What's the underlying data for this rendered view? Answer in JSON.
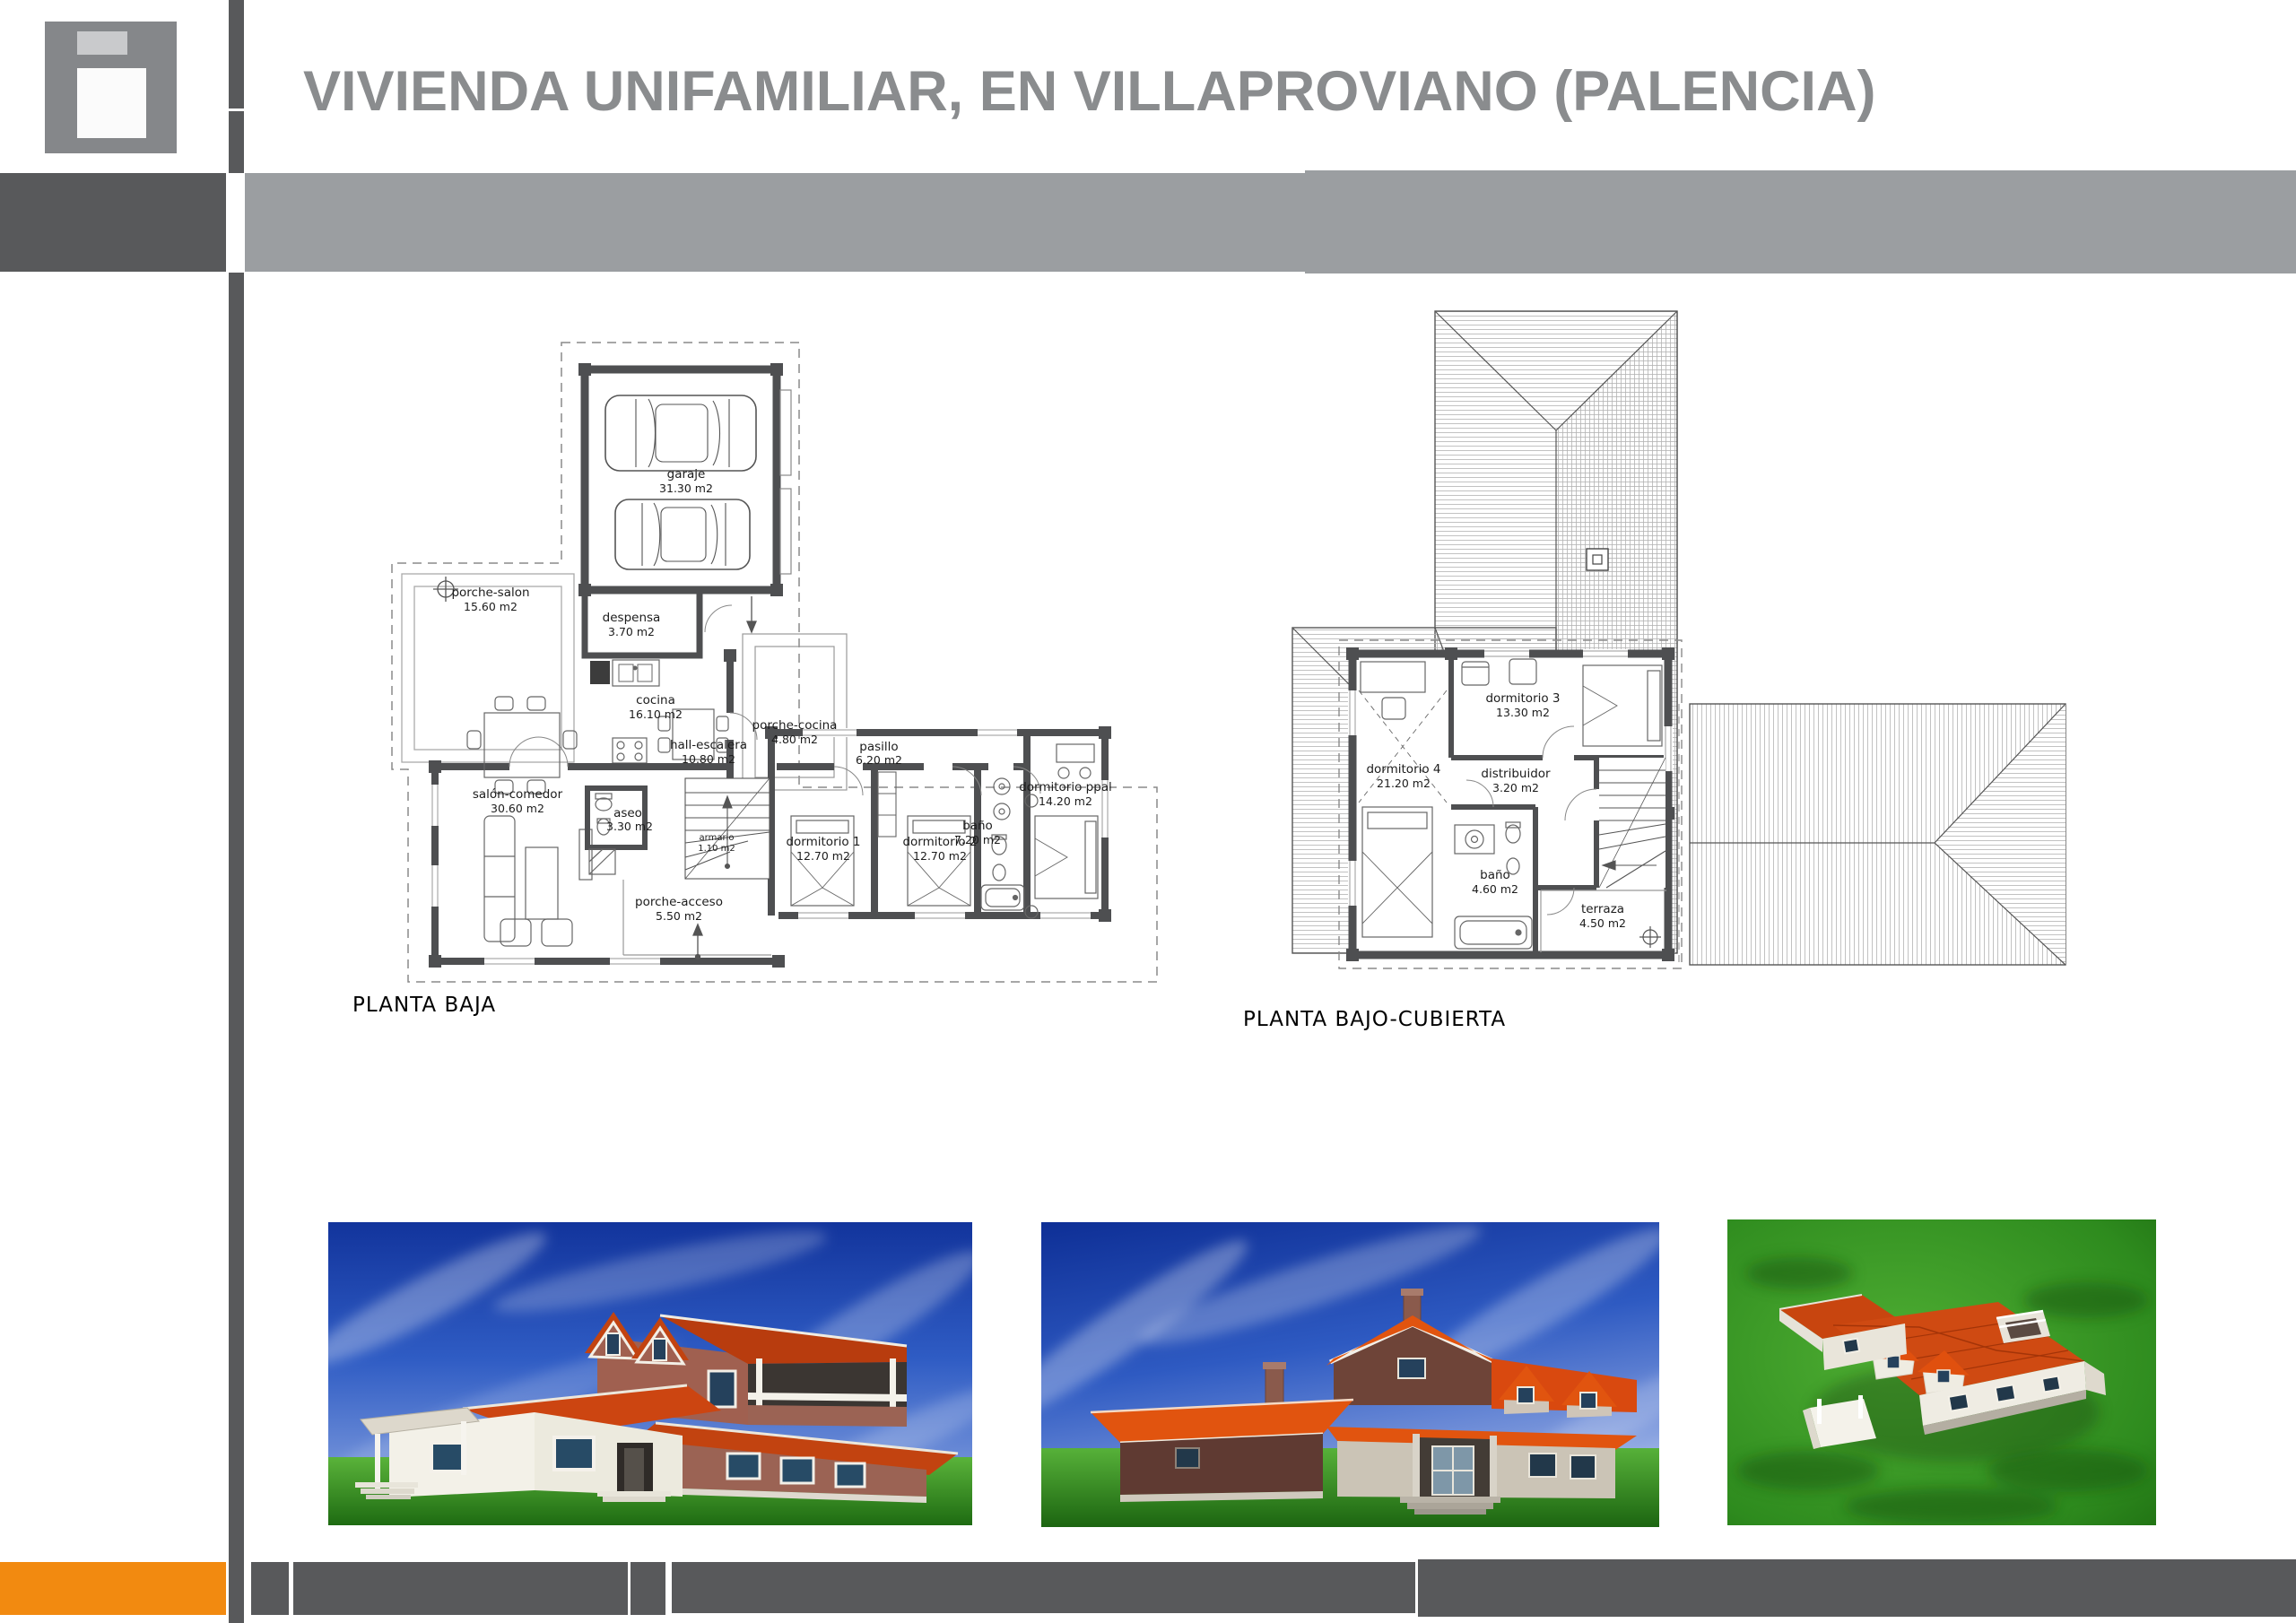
{
  "header": {
    "title": "VIVIENDA UNIFAMILIAR, EN VILLAPROVIANO (PALENCIA)"
  },
  "plans": [
    {
      "caption": "PLANTA BAJA",
      "rooms": [
        {
          "name": "garaje",
          "area": "31.30 m2"
        },
        {
          "name": "porche-salon",
          "area": "15.60 m2"
        },
        {
          "name": "despensa",
          "area": "3.70 m2"
        },
        {
          "name": "cocina",
          "area": "16.10 m2"
        },
        {
          "name": "porche-cocina",
          "area": "4.80 m2"
        },
        {
          "name": "salón-comedor",
          "area": "30.60 m2"
        },
        {
          "name": "hall-escalera",
          "area": "10.80 m2"
        },
        {
          "name": "aseo",
          "area": "3.30 m2"
        },
        {
          "name": "armario",
          "area": "1.10 m2"
        },
        {
          "name": "porche-acceso",
          "area": "5.50 m2"
        },
        {
          "name": "pasillo",
          "area": "6.20 m2"
        },
        {
          "name": "dormitorio 1",
          "area": "12.70 m2"
        },
        {
          "name": "dormitorio 2",
          "area": "12.70 m2"
        },
        {
          "name": "baño",
          "area": "7.20 m2"
        },
        {
          "name": "dormitorio ppal",
          "area": "14.20 m2"
        }
      ]
    },
    {
      "caption": "PLANTA BAJO-CUBIERTA",
      "rooms": [
        {
          "name": "dormitorio 3",
          "area": "13.30 m2"
        },
        {
          "name": "dormitorio 4",
          "area": "21.20 m2"
        },
        {
          "name": "distribuidor",
          "area": "3.20 m2"
        },
        {
          "name": "baño",
          "area": "4.60 m2"
        },
        {
          "name": "terraza",
          "area": "4.50 m2"
        }
      ]
    }
  ],
  "colors": {
    "accent_orange": "#F28A10",
    "dark_gray": "#58595B",
    "light_gray_band": "#9B9EA1",
    "logo_gray": "#85878A",
    "title_gray": "#8A8C8E",
    "plan_wall": "#4E4F51",
    "roof_red": "#CC4511",
    "sky_blue": "#2F5CC0",
    "grass_green": "#2E8B1E"
  }
}
